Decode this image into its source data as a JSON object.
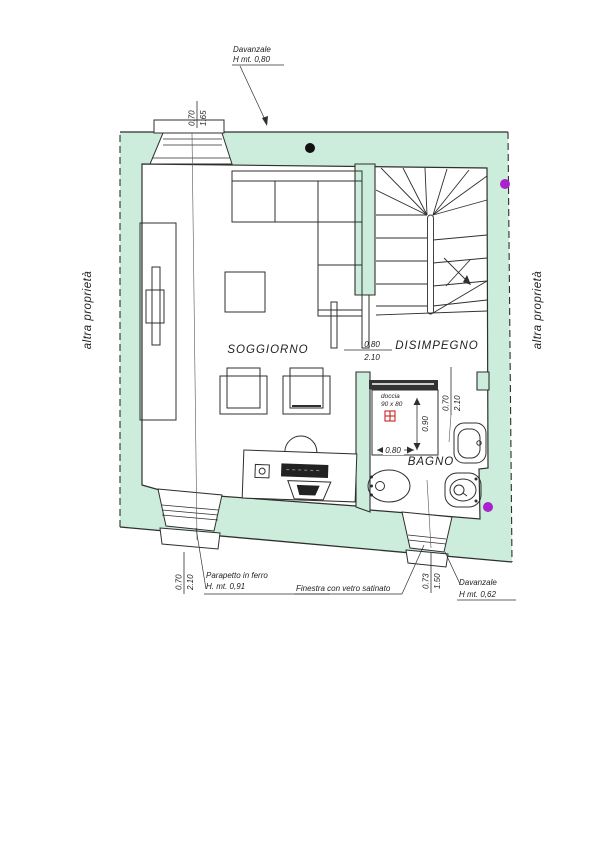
{
  "plan": {
    "rooms": {
      "living": "SOGGIORNO",
      "hall": "DISIMPEGNO",
      "bath": "BAGNO"
    },
    "neighbors": {
      "left": "altra proprietà",
      "right": "altra proprietà"
    },
    "annotations": {
      "sill_top_line1": "Davanzale",
      "sill_top_line2": "H mt. 0,80",
      "railing_line1": "Parapetto in ferro",
      "railing_line2": "H. mt. 0,91",
      "frosted_window": "Finestra con vetro satinato",
      "sill_bottom_line1": "Davanzale",
      "sill_bottom_line2": "H mt. 0,62",
      "shower_line1": "doccia",
      "shower_line2": "90 x 80"
    },
    "dims": {
      "top_window": {
        "w": "0.70",
        "h": "1.65"
      },
      "living_door": {
        "w": "0.80",
        "h": "2.10"
      },
      "bath_door": {
        "w": "0.70",
        "h": "2.10"
      },
      "balcony_door": {
        "w": "0.70",
        "h": "2.10"
      },
      "bath_window": {
        "w": "0.73",
        "h": "1.50"
      },
      "shower": {
        "width": "0.80",
        "depth": "0.90"
      }
    },
    "colors": {
      "wall": "#cceddc",
      "line": "#2f2f2f",
      "marker_purple": "#aa22cc",
      "marker_black": "#111111",
      "drain_red": "#cc2222"
    }
  }
}
